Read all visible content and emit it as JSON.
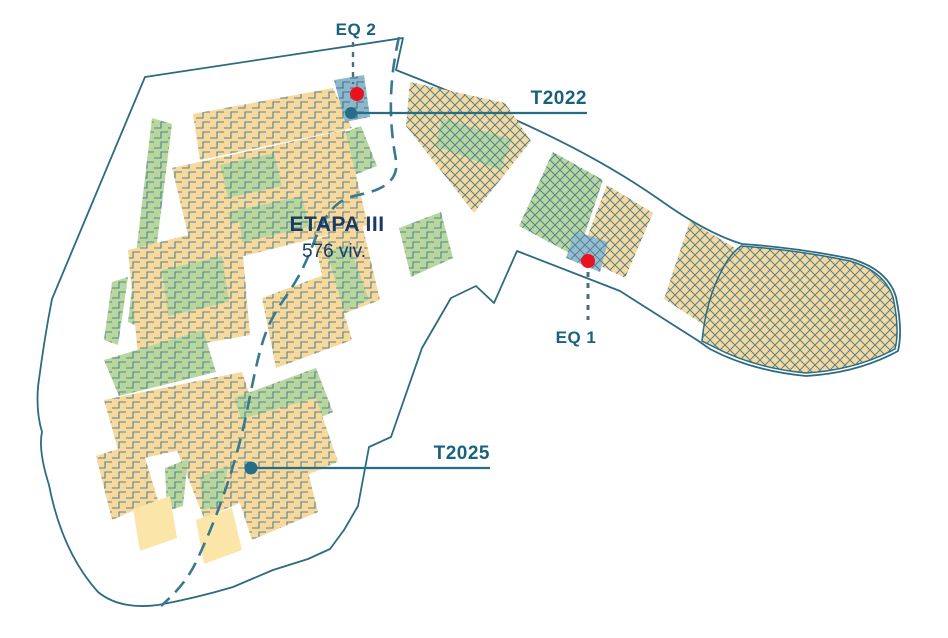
{
  "map": {
    "stage": {
      "title": "ETAPA III",
      "subtitle": "576 viv."
    },
    "callouts": {
      "eq2": "EQ 2",
      "t2022": "T2022",
      "eq1": "EQ 1",
      "t2025": "T2025"
    },
    "colors": {
      "residential_fill": "#F8D89B",
      "green_space_fill": "#B9D79C",
      "equipment_fill": "#8FB7CB",
      "reserve_fill": "#FCE5A9",
      "pattern_line": "#4F8496",
      "site_outline": "#2C6B82",
      "road_dashed": "#37798F",
      "marker_red": "#E8131F",
      "marker_teal": "#266E86",
      "callout_text": "#19617F",
      "title_text": "#1A3A64"
    }
  }
}
